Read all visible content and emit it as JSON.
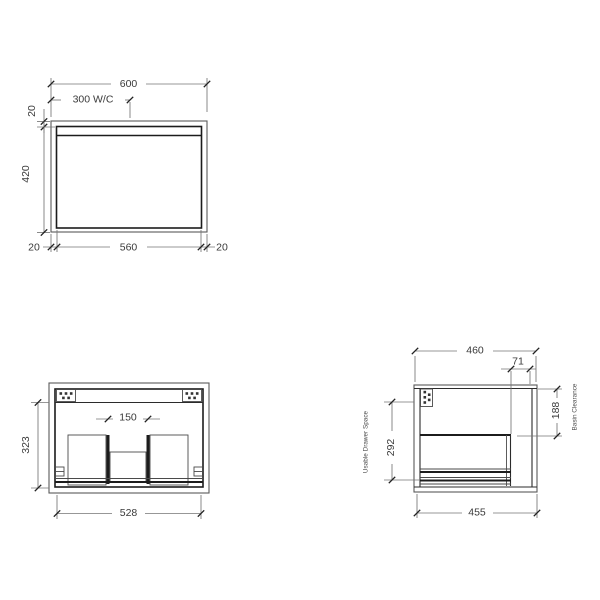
{
  "front_view": {
    "width_dim": "600",
    "wc_dim": "300 W/C",
    "top_panel_dim": "20",
    "height_dim": "420",
    "bottom_left_dim": "20",
    "bottom_width_dim": "560",
    "bottom_right_dim": "20"
  },
  "internal_view": {
    "gap_dim": "150",
    "height_dim": "323",
    "width_dim": "528"
  },
  "side_view": {
    "depth_dim": "460",
    "front_offset_dim": "71",
    "basin_clearance_dim": "188",
    "drawer_space_dim": "292",
    "bottom_depth_dim": "455",
    "drawer_space_label": "Usable Drawer Space",
    "basin_clearance_label": "Basin Clearance"
  },
  "colors": {
    "background": "#ffffff",
    "object_line": "#1c1c1c",
    "outline": "#5a5a5a",
    "dim_line": "#757575",
    "text": "#3a3a3a"
  }
}
